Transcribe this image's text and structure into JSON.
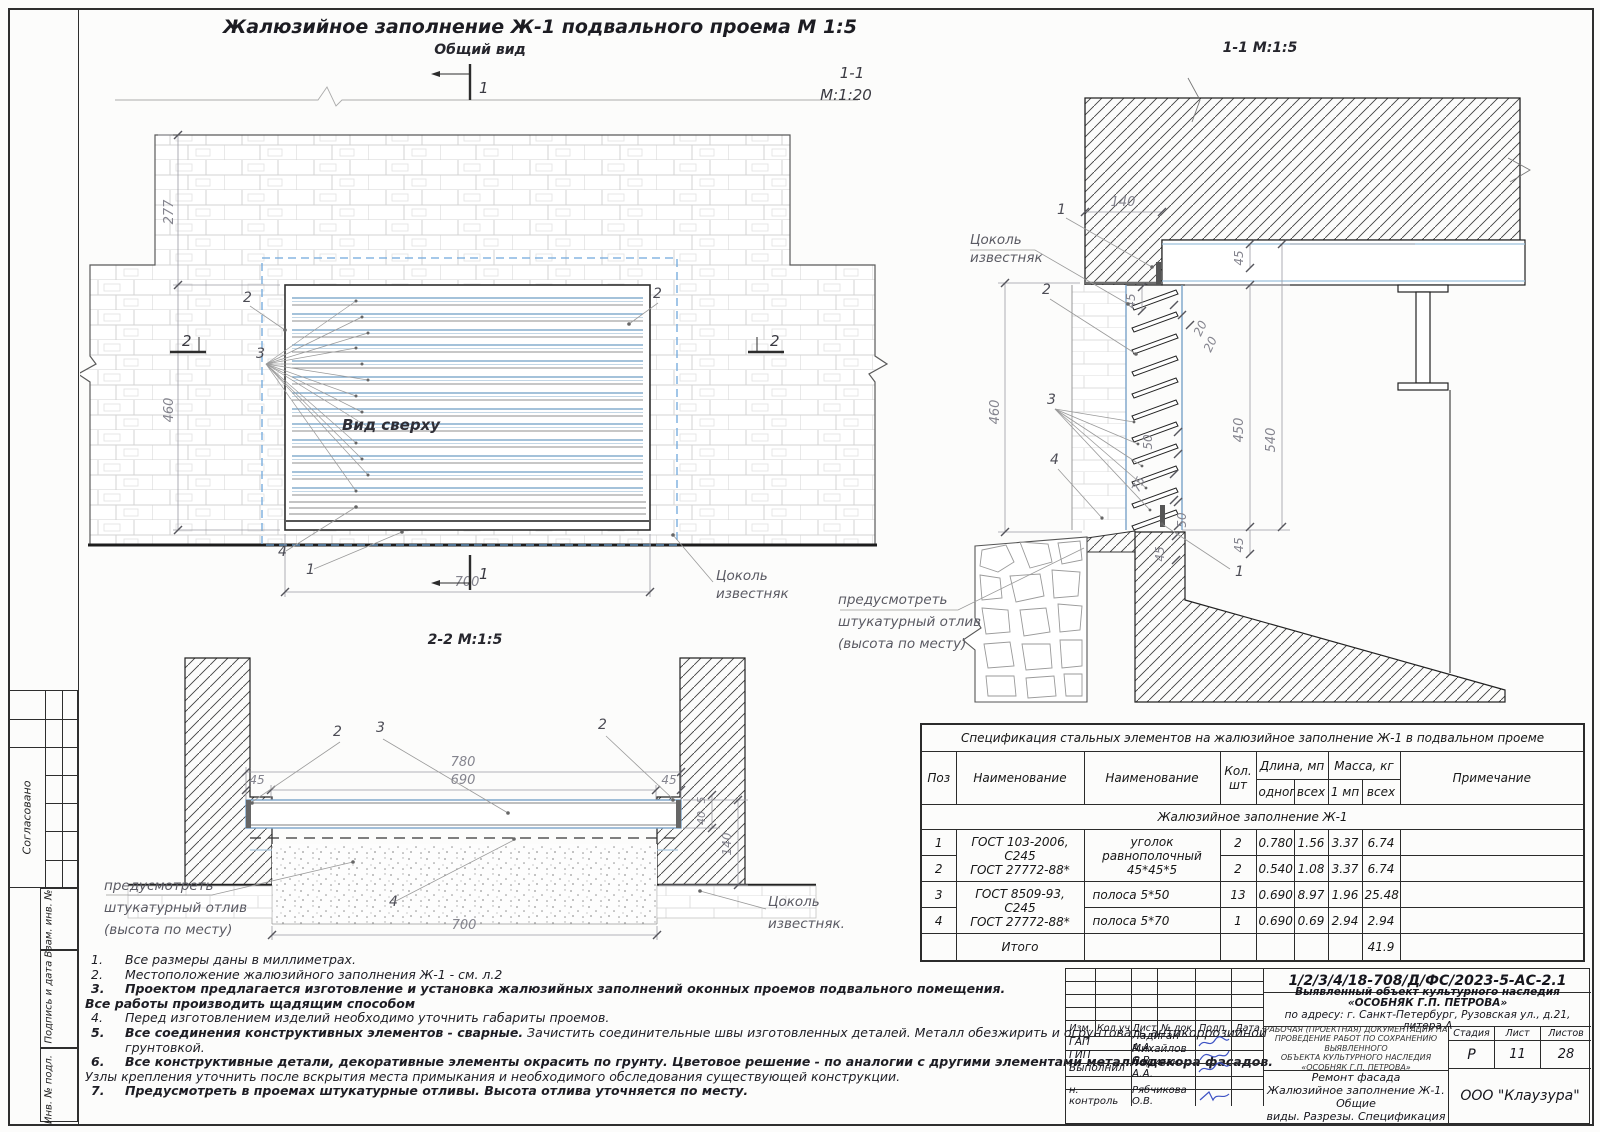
{
  "sheet": {
    "title": "Жалюзийное заполнение Ж-1 подвального проема    М 1:5",
    "general_view_label": "Общий вид",
    "s11_small_1": "1-1",
    "s11_small_2": "М:1:20",
    "s11_title": "1-1 М:1:5",
    "s22_title": "2-2 М:1:5"
  },
  "frame": {
    "approved": "Согласовано",
    "vzam": "Взам. инв. №",
    "podpis": "Подпись и дата",
    "inv": "Инв. № подл."
  },
  "gv": {
    "d277": "277",
    "d460": "460",
    "d700": "700",
    "mark1_top": "1",
    "mark1_bottom": "1",
    "mark2_left": "2",
    "mark2_right": "2",
    "c2l": "2",
    "c2r": "2",
    "c3": "3",
    "c4": "4",
    "c1": "1",
    "vid_sverhu": "Вид сверху",
    "tsokol1": "Цоколь",
    "tsokol2": "известняк"
  },
  "s11": {
    "d140": "140",
    "d45_top": "45",
    "d45_slab": "45",
    "d20a": "20",
    "d20b": "20",
    "d460": "460",
    "d50_mid": "50",
    "d450": "450",
    "d540": "540",
    "d75": "75",
    "d50_bot": "50",
    "d45_b1": "45",
    "d45_b2": "45",
    "c1_top": "1",
    "c2": "2",
    "c3": "3",
    "c4": "4",
    "c1_bot": "1",
    "tsokol1": "Цоколь",
    "tsokol2": "известняк",
    "otliv1": "предусмотреть",
    "otliv2": "штукатурный отлив",
    "otliv3": "(высота по месту)"
  },
  "s22": {
    "d780": "780",
    "d690": "690",
    "d45l": "45",
    "d45r": "45",
    "d700": "700",
    "d5": "5",
    "d40": "40",
    "d140": "140",
    "c2l": "2",
    "c3": "3",
    "c2r": "2",
    "c4": "4",
    "otliv1": "предусмотреть",
    "otliv2": "штукатурный отлив",
    "otliv3": "(высота по месту)",
    "tsokol1": "Цоколь",
    "tsokol2": "известняк."
  },
  "spec": {
    "title": "Спецификация стальных элементов на жалюзийное заполнение Ж-1 в подвальном проеме",
    "h_poz": "Поз",
    "h_naim1": "Наименование",
    "h_naim2": "Наименование",
    "h_kol": "Кол. шт",
    "h_dlina": "Длина, мп",
    "h_massa": "Масса, кг",
    "h_odnogo": "одного",
    "h_vseh1": "всех",
    "h_1mp": "1 мп",
    "h_vseh2": "всех",
    "h_prim": "Примечание",
    "group": "Жалюзийное заполнение Ж-1",
    "gost12a": "ГОСТ 103-2006, С245",
    "gost12b": "ГОСТ 27772-88*",
    "gost34a": "ГОСТ 8509-93, С245",
    "gost34b": "ГОСТ 27772-88*",
    "naim12": "уголок равнополочный 45*45*5",
    "naim3": "полоса 5*50",
    "naim4": "полоса 5*70",
    "rows": [
      {
        "poz": "1",
        "kol": "2",
        "odnogo": "0.780",
        "vseh": "1.56",
        "mp": "3.37",
        "massa": "6.74"
      },
      {
        "poz": "2",
        "kol": "2",
        "odnogo": "0.540",
        "vseh": "1.08",
        "mp": "3.37",
        "massa": "6.74"
      },
      {
        "poz": "3",
        "kol": "13",
        "odnogo": "0.690",
        "vseh": "8.97",
        "mp": "1.96",
        "massa": "25.48"
      },
      {
        "poz": "4",
        "kol": "1",
        "odnogo": "0.690",
        "vseh": "0.69",
        "mp": "2.94",
        "massa": "2.94"
      }
    ],
    "total_label": "Итого",
    "total_value": "41.9"
  },
  "notes": {
    "t1": "Все размеры даны в миллиметрах.",
    "t2": "Местоположение жалюзийного заполнения Ж-1 - см. л.2",
    "t3": "Проектом предлагается изготовление и установка жалюзийных заполнений оконных проемов подвального помещения.",
    "t3b": "Все работы производить щадящим способом",
    "t4": "Перед изготовлением изделий необходимо уточнить габариты проемов.",
    "t5a": "Все соединения конструктивных элементов - сварные.",
    "t5b": " Зачистить соединительные швы изготовленных деталей. Металл обезжирить и огрунтовать антикоррозийной",
    "t5c": "грунтовкой.",
    "t6": "Все конструктивные детали, декоративные элементы окрасить по грунту. Цветовое решение - по аналогии с другими элементами металлодекора фасадов.",
    "t6b": "Узлы крепления   уточнить после вскрытия места примыкания и необходимого обследования существующей конструкции.",
    "t7": "Предусмотреть в проемах штукатурные отливы. Высота отлива уточняется по месту.",
    "n1": "1.",
    "n2": "2.",
    "n3": "3.",
    "n4": "4.",
    "n5": "5.",
    "n6": "6.",
    "n7": "7."
  },
  "stamp": {
    "doc_number": "1/2/3/4/18-708/Д/ФС/2023-5-АС-2.1",
    "object1": "Выявленный объект культурного наследия",
    "object2": "«ОСОБНЯК Г.П. ПЕТРОВА»",
    "object3": "по адресу: г. Санкт-Петербург, Рузовская ул., д.21, литера А",
    "h_izm": "Изм.",
    "h_koluch": "Кол.уч",
    "h_list": "Лист",
    "h_ndok": "№ док",
    "h_podp": "Подп.",
    "h_data": "Дата",
    "r1_role": "ГАП",
    "r1_name": "Ладиган А.А.",
    "r2_role": "ГИП",
    "r2_name": "Михайлов С.В.",
    "r3_role": "Выполнил",
    "r3_name": "Ладиган А.А.",
    "r4_role": "н. контроль",
    "r4_name": "Рябчикова О.В.",
    "work_doc1": "РАБОЧАЯ (ПРОЕКТНАЯ) ДОКУМЕНТАЦИЯ НА",
    "work_doc2": "ПРОВЕДЕНИЕ РАБОТ ПО СОХРАНЕНИЮ ВЫЯВЛЕННОГО",
    "work_doc3": "ОБЪЕКТА КУЛЬТУРНОГО НАСЛЕДИЯ",
    "work_doc4": "«ОСОБНЯК Г.П. ПЕТРОВА»",
    "sheet_name1": "Ремонт фасада",
    "sheet_name2": "Жалюзийное заполнение Ж-1. Общие",
    "sheet_name3": "виды. Разрезы. Спецификация",
    "h_stage": "Стадия",
    "h_sheet": "Лист",
    "h_sheets": "Листов",
    "stage": "Р",
    "sheet_no": "11",
    "sheets_total": "28",
    "company": "ООО \"Клаузура\""
  }
}
